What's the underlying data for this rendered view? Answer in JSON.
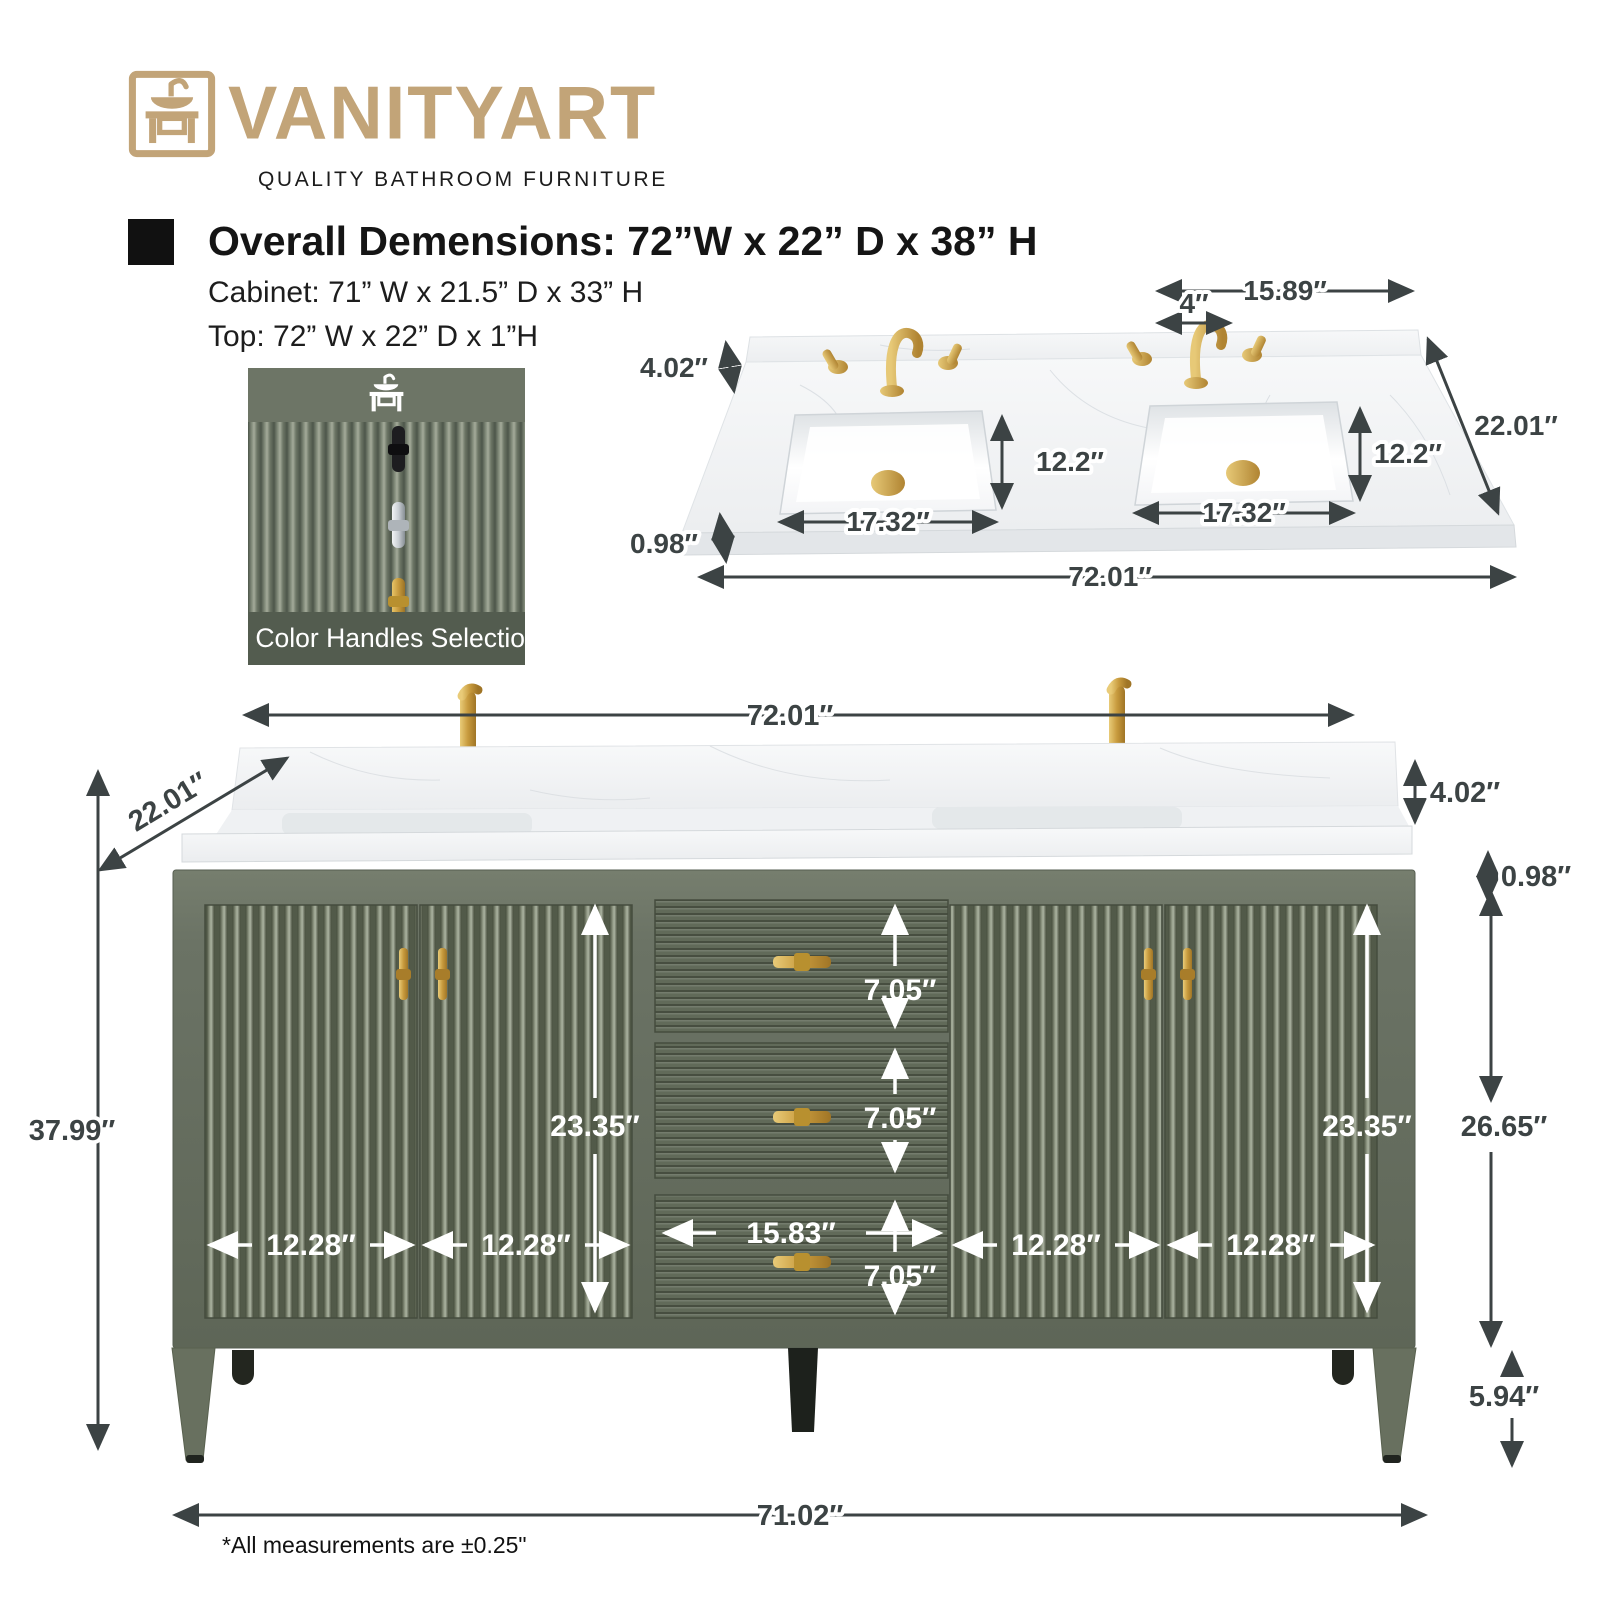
{
  "brand": {
    "name": "VANITYART",
    "tagline": "QUALITY BATHROOM FURNITURE",
    "logo_gold": "#c2a478"
  },
  "specs": {
    "overall": "Overall Demensions: 72”W x 22” D x 38” H",
    "cabinet": "Cabinet: 71” W x 21.5” D x 33” H",
    "top": "Top: 72” W x 22” D x 1”H"
  },
  "handles_card": {
    "caption": "3 Color Handles Selection",
    "options": [
      "black",
      "chrome",
      "gold"
    ]
  },
  "top_view": {
    "w_1589": "15.89″",
    "w_4": "4″",
    "h_402": "4.02″",
    "d_122": "12.2″",
    "d_2201": "22.01″",
    "w_1732": "17.32″",
    "t_098": "0.98″",
    "w_7201": "72.01″"
  },
  "front_view": {
    "w_7201": "72.01″",
    "d_2201": "22.01″",
    "h_3799": "37.99″",
    "h_402": "4.02″",
    "t_098": "0.98″",
    "h_2665": "26.65″",
    "h_2335": "23.35″",
    "h_705": "7.05″",
    "w_1583": "15.83″",
    "w_1228": "12.28″",
    "h_594": "5.94″",
    "w_7102": "71.02″"
  },
  "footnote": "*All measurements are ±0.25\"",
  "colors": {
    "logo_gold": "#c2a478",
    "cabinet_green": "#6b7365",
    "accent_gold": "#c79a3d",
    "dim_text": "#3c4344"
  }
}
